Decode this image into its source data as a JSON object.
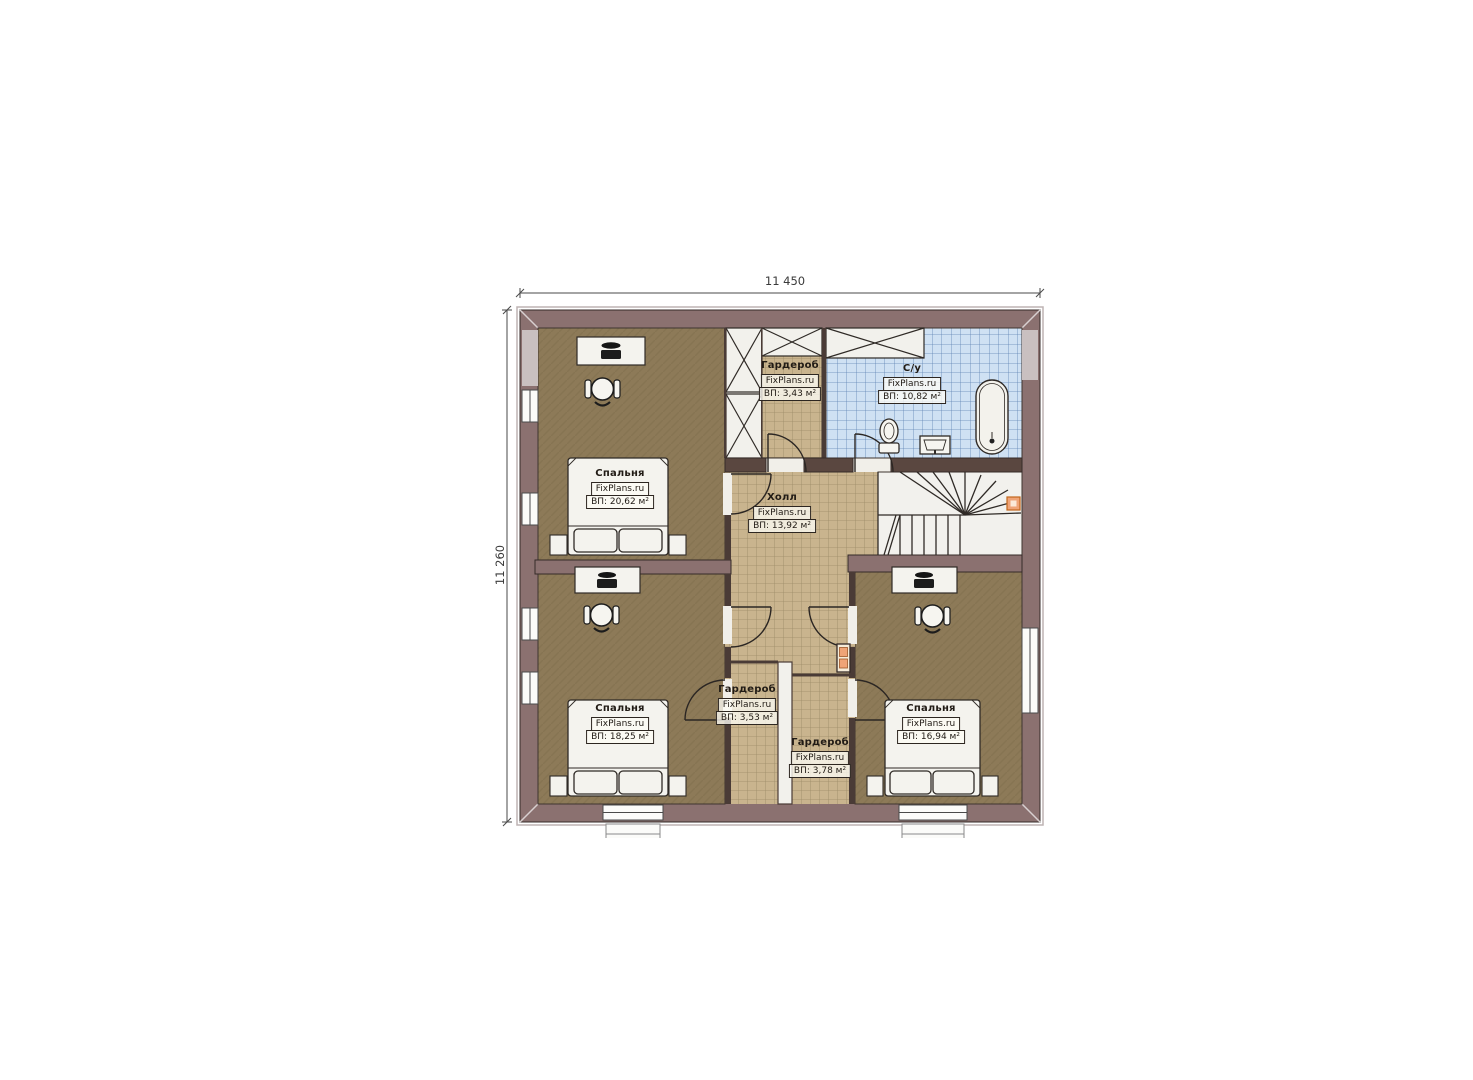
{
  "dimensions": {
    "width_label": "11 450",
    "height_label": "11 260"
  },
  "rooms": {
    "bedroom_tl": {
      "name": "Спальня",
      "brand": "FixPlans.ru",
      "area": "ВП: 20,62 м²"
    },
    "wardrobe_top": {
      "name": "Гардероб",
      "brand": "FixPlans.ru",
      "area": "ВП: 3,43 м²"
    },
    "bathroom": {
      "name": "С/у",
      "brand": "FixPlans.ru",
      "area": "ВП: 10,82 м²"
    },
    "hall": {
      "name": "Холл",
      "brand": "FixPlans.ru",
      "area": "ВП: 13,92 м²"
    },
    "bedroom_bl": {
      "name": "Спальня",
      "brand": "FixPlans.ru",
      "area": "ВП: 18,25 м²"
    },
    "wardrobe_bl": {
      "name": "Гардероб",
      "brand": "FixPlans.ru",
      "area": "ВП: 3,53 м²"
    },
    "wardrobe_br": {
      "name": "Гардероб",
      "brand": "FixPlans.ru",
      "area": "ВП: 3,78 м²"
    },
    "bedroom_br": {
      "name": "Спальня",
      "brand": "FixPlans.ru",
      "area": "ВП: 16,94 м²"
    }
  },
  "colors": {
    "wall": "#8b7170",
    "wall_outline": "#352b28",
    "partition": "#4a3b36",
    "bedroom_floor": "#8d7a58",
    "tile_floor": "#c9b48e",
    "tile_grid": "#9b8a66",
    "bath_tile": "#cfe1f3",
    "bath_grid": "#5f83b3",
    "furniture": "#f4f3ee",
    "accent_orange": "#efa477",
    "dimension_text": "#3a3a3a"
  }
}
